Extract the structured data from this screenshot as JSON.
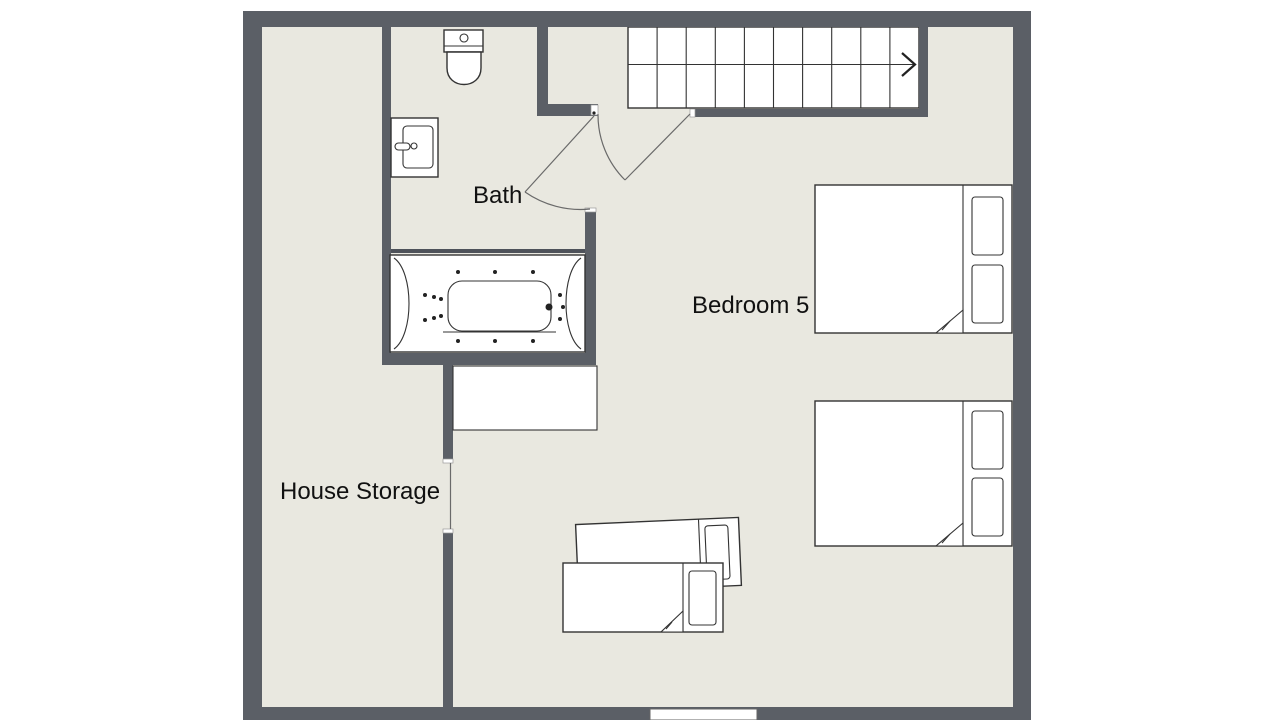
{
  "title": "Floor plan - upper level",
  "rooms": [
    {
      "id": "bath",
      "label": "Bath"
    },
    {
      "id": "bedroom5",
      "label": "Bedroom 5"
    },
    {
      "id": "house-storage",
      "label": "House Storage"
    }
  ],
  "stairs": {
    "steps": 10,
    "rows": 2,
    "direction_arrow": "right"
  },
  "fixtures": {
    "bath": [
      "toilet",
      "sink-vanity",
      "jacuzzi-bathtub"
    ],
    "bedroom5": {
      "double_beds": 2,
      "single_beds": 2,
      "cupboard": 1
    },
    "doors": 3,
    "windows": 1
  },
  "colors": {
    "background": "#ffffff",
    "floor": "#e9e8e0",
    "wall": "#5b5f66",
    "fixture_fill": "#ffffff",
    "outline": "#333333",
    "label_text": "#111111"
  }
}
